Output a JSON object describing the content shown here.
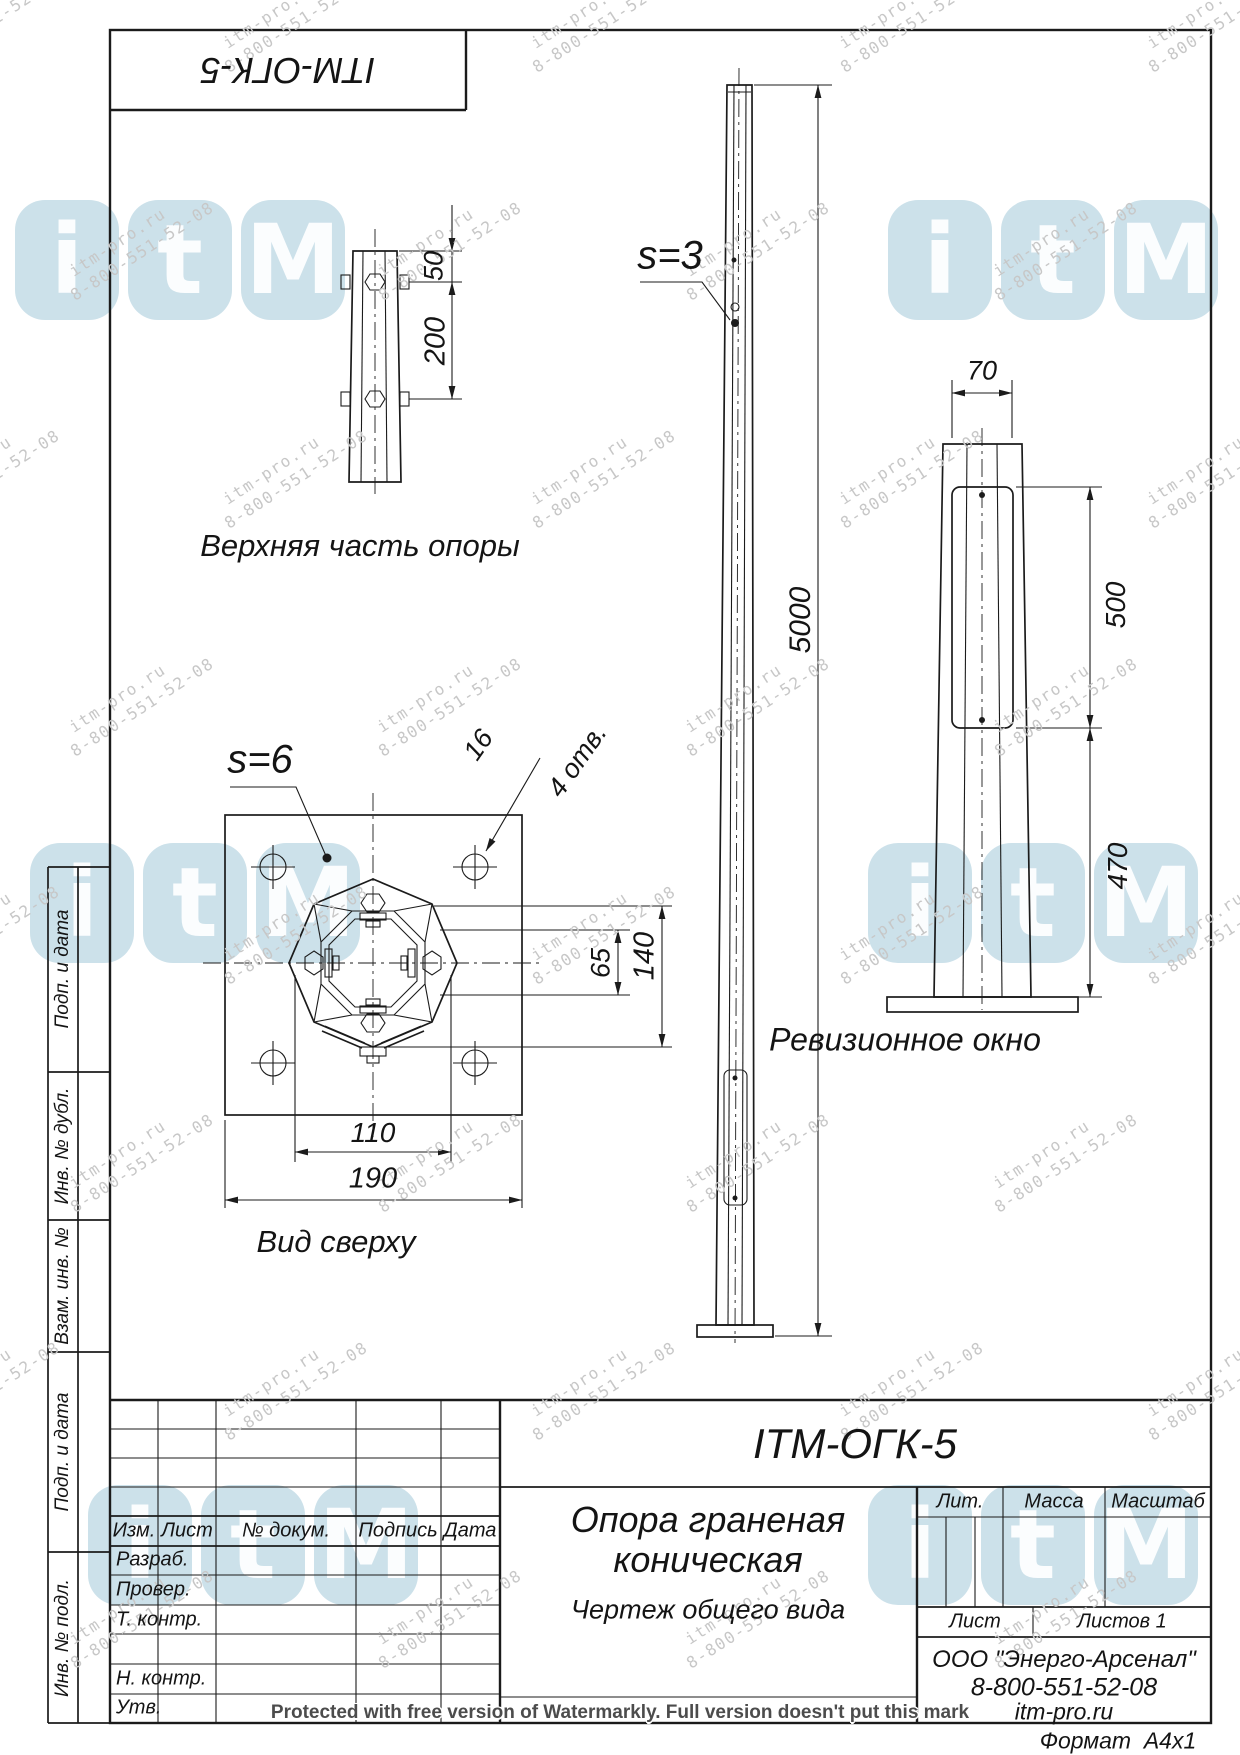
{
  "corner_stamp": {
    "designation": "ITM-ОГК-5"
  },
  "views": {
    "top_detail": {
      "title": "Верхняя часть опоры",
      "dims": {
        "d50": "50",
        "d200": "200"
      }
    },
    "front": {
      "thickness_callout": "s=3",
      "dims": {
        "height": "5000"
      }
    },
    "revision": {
      "title": "Ревизионное окно",
      "dims": {
        "width": "70",
        "window": "500",
        "bottom": "470"
      }
    },
    "top_view": {
      "title": "Вид сверху",
      "thickness_callout": "s=6",
      "holes_dia": "16",
      "holes_count": "4 отв.",
      "dims": {
        "d65": "65",
        "d140": "140",
        "d110": "110",
        "d190": "190"
      }
    }
  },
  "title_block": {
    "designation": "ITM-ОГК-5",
    "name_line1": "Опора граненая",
    "name_line2": "коническая",
    "doc_type": "Чертеж общего вида",
    "col_izm": "Изм.",
    "col_list": "Лист",
    "col_doc": "№ докум.",
    "col_sign": "Подпись",
    "col_date": "Дата",
    "row_labels": [
      "Разраб.",
      "Провер.",
      "Т. контр.",
      "",
      "Н. контр.",
      "Утв."
    ],
    "lit_label": "Лит.",
    "mass_label": "Масса",
    "scale_label": "Масштаб",
    "sheet_label": "Лист",
    "sheets_label": "Листов 1",
    "company_name": "ООО \"Энерго-Арсенал\"",
    "company_phone": "8-800-551-52-08",
    "company_site": "itm-pro.ru",
    "format_label": "Формат  А4х1"
  },
  "side_labels": [
    "Подп. и дата",
    "Инв. № дубл.",
    "Взам. инв. №",
    "Подп. и дата",
    "Инв. № подл."
  ],
  "watermark": {
    "line1": "itm-pro.ru",
    "line2": "8-800-551-52-08",
    "logo_letters": [
      "i",
      "t",
      "M"
    ],
    "logo_color": "#a3c9d9",
    "text_color": "#c7c7c7",
    "protected_text": "Protected with free version of Watermarkly. Full version doesn't put this mark"
  }
}
